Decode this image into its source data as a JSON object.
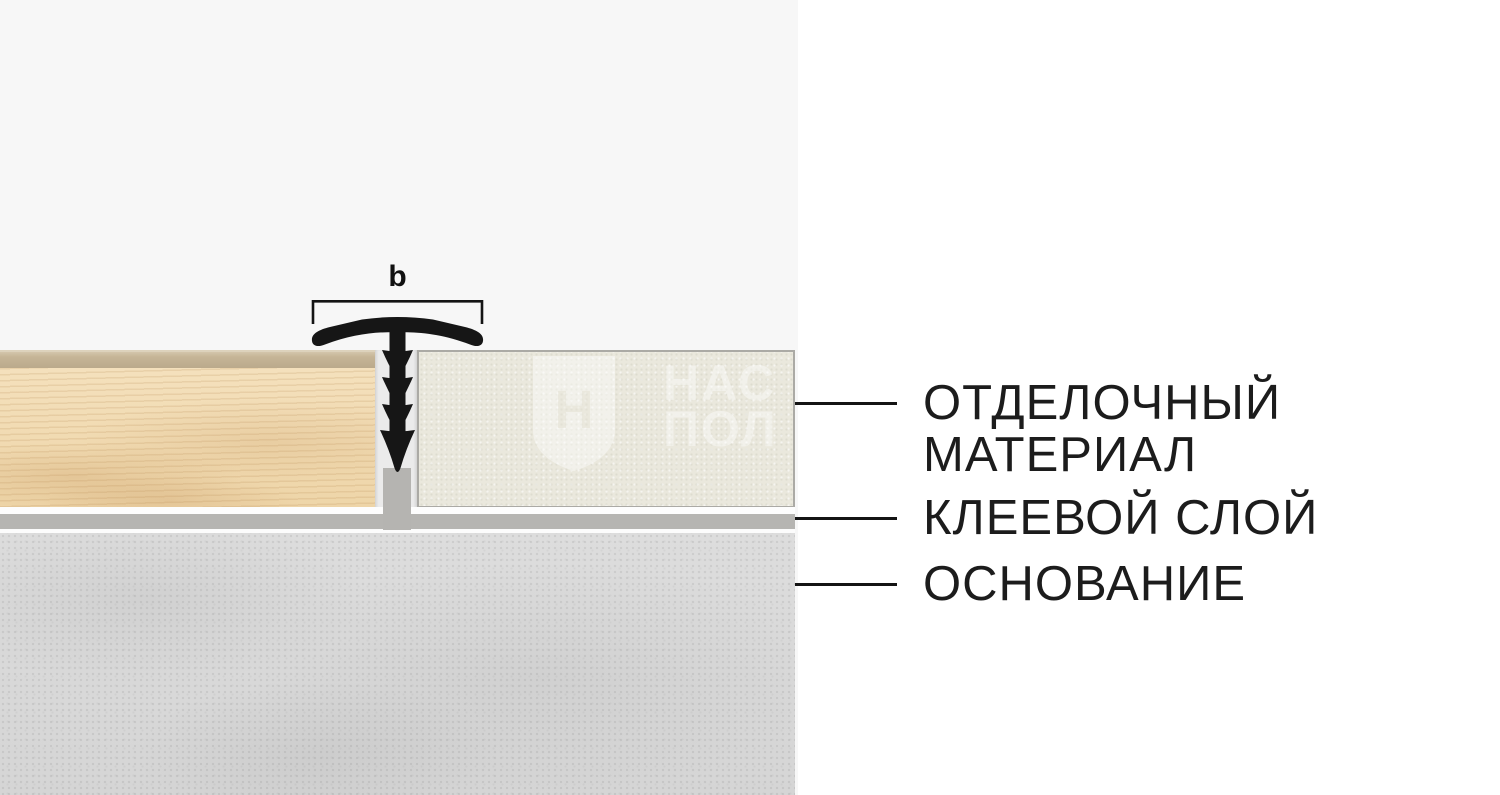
{
  "canvas": {
    "background": "#ffffff",
    "panel_background": "#f7f7f7"
  },
  "diagram": {
    "dimension_label": "b",
    "profile": {
      "kind": "t-shaped transition profile",
      "color": "#161616"
    },
    "bracket_color": "#141414",
    "layers": {
      "wood": {
        "base_color": "#f0d9b2",
        "bevel_color": "#c2b195"
      },
      "finish_sheet": {
        "base_color": "#eae8dd",
        "border_color": "#abaaa5"
      },
      "adhesive": {
        "color": "#b6b5b2"
      },
      "base_concrete": {
        "color": "#d9d9d9"
      }
    },
    "watermark": {
      "shield_letter": "Н",
      "line1": "НАС",
      "line2": "ПОЛ"
    }
  },
  "labels": {
    "text_color": "#1c1c1c",
    "leader_color": "#141414",
    "items": [
      {
        "id": "finish-material",
        "lines": [
          "ОТДЕЛОЧНЫЙ",
          "МАТЕРИАЛ"
        ]
      },
      {
        "id": "adhesive-layer",
        "lines": [
          "КЛЕЕВОЙ СЛОЙ"
        ]
      },
      {
        "id": "base",
        "lines": [
          "ОСНОВАНИЕ"
        ]
      }
    ]
  }
}
